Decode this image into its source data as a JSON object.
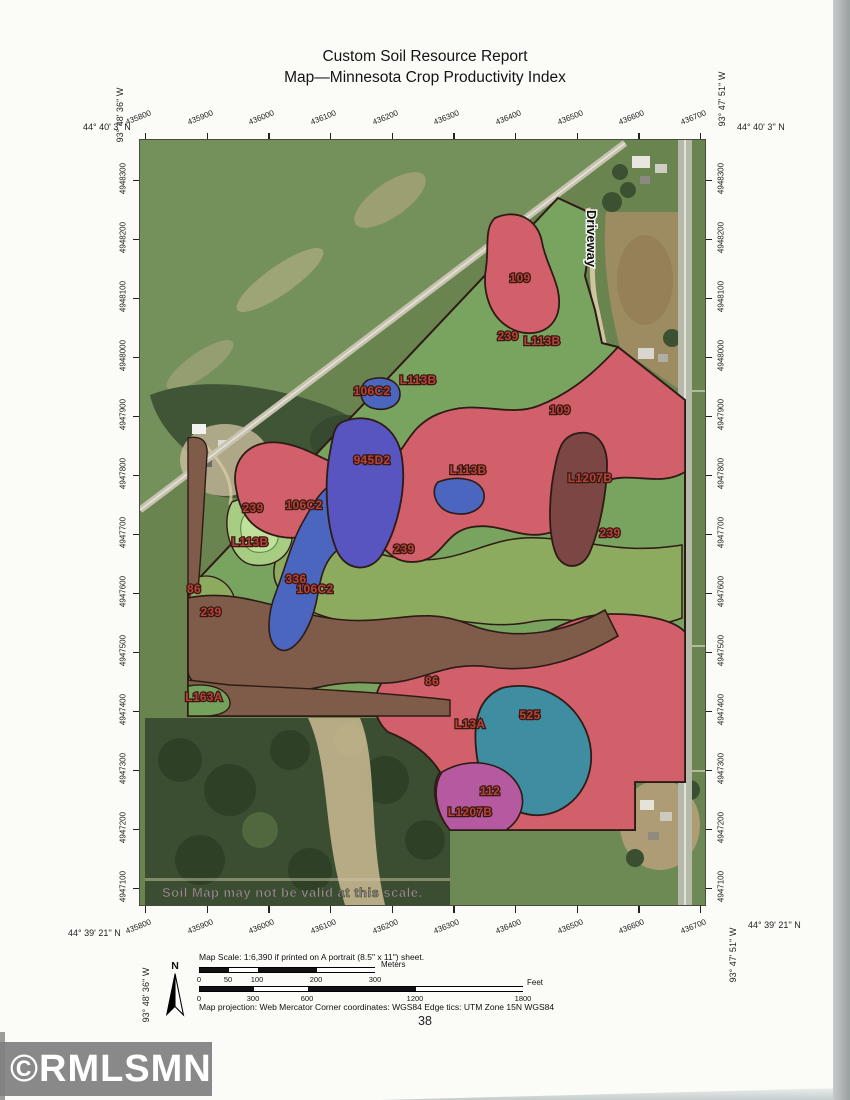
{
  "report": {
    "title_line1": "Custom Soil Resource Report",
    "title_line2": "Map—Minnesota Crop Productivity Index",
    "page_number": "38"
  },
  "corners": {
    "top_left_lat": "44°  40' 3'' N",
    "top_right_lat": "44°  40' 3'' N",
    "bottom_left_lat": "44°  39' 21'' N",
    "bottom_right_lat": "44°  39' 21'' N",
    "left_lon": "93°  48' 36'' W",
    "right_lon": "93°  47' 51'' W"
  },
  "axes": {
    "top_ticks": [
      "435800",
      "435900",
      "436000",
      "436100",
      "436200",
      "436300",
      "436400",
      "436500",
      "436600",
      "436700"
    ],
    "bottom_ticks": [
      "435800",
      "435900",
      "436000",
      "436100",
      "436200",
      "436300",
      "436400",
      "436500",
      "436600",
      "436700"
    ],
    "left_ticks": [
      "4948300",
      "4948200",
      "4948100",
      "4948000",
      "4947900",
      "4947800",
      "4947700",
      "4947600",
      "4947500",
      "4947400",
      "4947300",
      "4947200",
      "4947100"
    ],
    "right_ticks": [
      "4948300",
      "4948200",
      "4948100",
      "4948000",
      "4947900",
      "4947800",
      "4947700",
      "4947600",
      "4947500",
      "4947400",
      "4947300",
      "4947200",
      "4947100"
    ]
  },
  "map": {
    "driveway_label": "Driveway",
    "disclaimer": "Soil Map may not be valid at this scale.",
    "soil_labels": [
      {
        "text": "109",
        "x": 380,
        "y": 142
      },
      {
        "text": "239",
        "x": 368,
        "y": 200
      },
      {
        "text": "L113B",
        "x": 402,
        "y": 205
      },
      {
        "text": "106C2",
        "x": 232,
        "y": 255
      },
      {
        "text": "L113B",
        "x": 278,
        "y": 244
      },
      {
        "text": "109",
        "x": 420,
        "y": 274
      },
      {
        "text": "945D2",
        "x": 232,
        "y": 324
      },
      {
        "text": "L113B",
        "x": 328,
        "y": 334
      },
      {
        "text": "L1207B",
        "x": 450,
        "y": 342
      },
      {
        "text": "239",
        "x": 113,
        "y": 372
      },
      {
        "text": "106C2",
        "x": 164,
        "y": 369
      },
      {
        "text": "L113B",
        "x": 110,
        "y": 406
      },
      {
        "text": "239",
        "x": 264,
        "y": 413
      },
      {
        "text": "239",
        "x": 470,
        "y": 397
      },
      {
        "text": "86",
        "x": 54,
        "y": 453
      },
      {
        "text": "336",
        "x": 156,
        "y": 443
      },
      {
        "text": "106C2",
        "x": 175,
        "y": 453
      },
      {
        "text": "239",
        "x": 71,
        "y": 476
      },
      {
        "text": "86",
        "x": 292,
        "y": 545
      },
      {
        "text": "L163A",
        "x": 64,
        "y": 561
      },
      {
        "text": "525",
        "x": 390,
        "y": 579
      },
      {
        "text": "L13A",
        "x": 330,
        "y": 588
      },
      {
        "text": "112",
        "x": 350,
        "y": 655
      },
      {
        "text": "L1207B",
        "x": 330,
        "y": 676
      }
    ],
    "zone_colors": {
      "red_109_L13A": "#d2606b",
      "green_L113B": "#79a45f",
      "olive_239": "#8cab5f",
      "blue_106C2_336": "#4b66bf",
      "purple_945D2": "#5854c0",
      "maroon_L1207B": "#7b4644",
      "brown_86": "#7f5c49",
      "teal_525": "#3f8da0",
      "magenta_112": "#b55aa0"
    }
  },
  "scale": {
    "north_label": "N",
    "map_scale_text": "Map Scale: 1:6,390 if printed on A portrait (8.5\" x 11\") sheet.",
    "meters_unit": "Meters",
    "feet_unit": "Feet",
    "meters_ticks": [
      "0",
      "50",
      "100",
      "200",
      "300"
    ],
    "feet_ticks": [
      "0",
      "300",
      "600",
      "1200",
      "1800"
    ],
    "projection_text": "Map projection:  Web Mercator   Corner coordinates:  WGS84   Edge tics:  UTM Zone 15N WGS84"
  },
  "watermark": {
    "text": "©RMLSMN"
  }
}
